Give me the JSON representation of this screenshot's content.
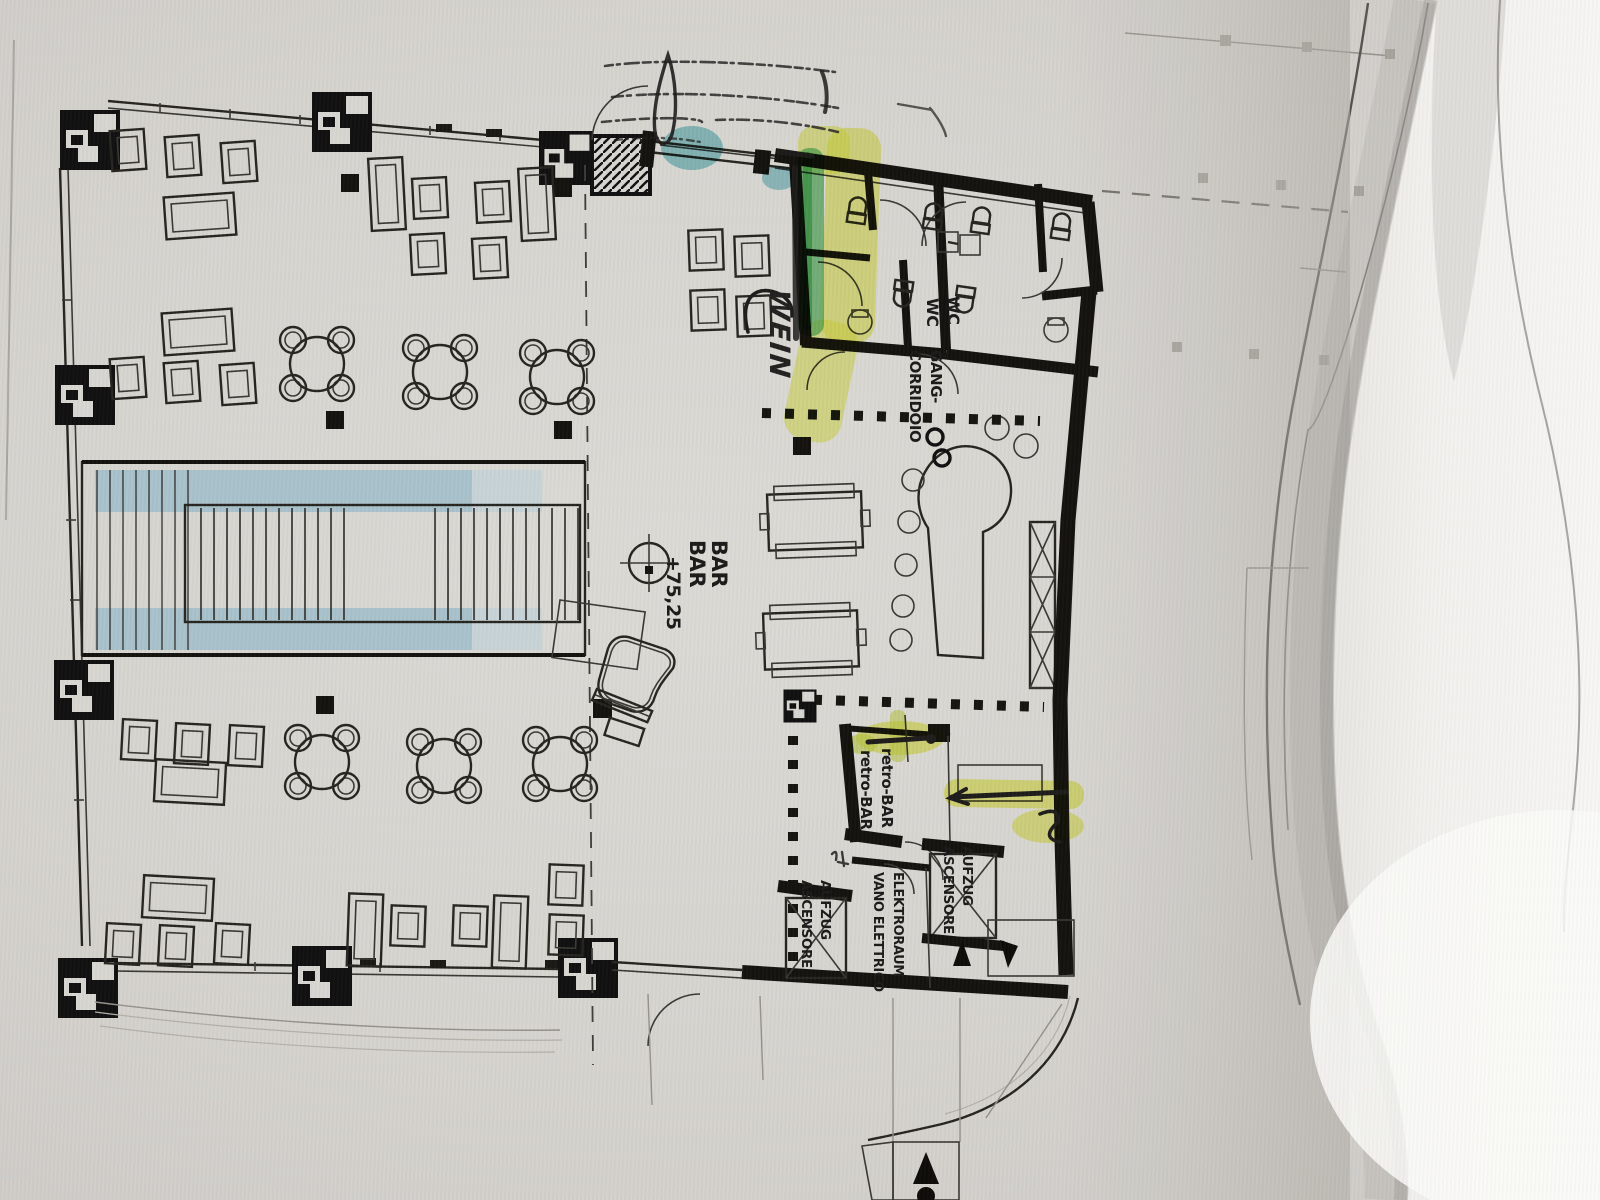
{
  "scene": {
    "kind": "photographed architectural floor plan sheet with highlighter and pen annotations",
    "paper_color": "#d8d5d0",
    "under_sheet_color": "#f2f1ee"
  },
  "plan_labels": {
    "bar": {
      "line1": "BAR",
      "line2": "BAR",
      "level": "+75,25"
    },
    "wc": {
      "line1": "WC",
      "line2": "WC"
    },
    "corridor": {
      "line1": "GANG-",
      "line2": "CORRIDOIO"
    },
    "retro_bar": {
      "line1": "retro-BAR",
      "line2": "retro-BAR"
    },
    "elevator_right": {
      "line1": "AUFZUG",
      "line2": "ASCENSORE"
    },
    "elevator_left": {
      "line1": "AUFZUG",
      "line2": "ASCENSORE"
    },
    "electrical_room": {
      "line1": "ELEKTRORAUM",
      "line2": "VANO ELETTRICO"
    }
  },
  "annotations": {
    "handwritten_word": "WEIN",
    "highlighter_yellow": "#e6ef3f",
    "highlighter_green": "#3fae4d",
    "highlighter_teal": "#46aebb",
    "stair_print_tint": "#a6c0ca"
  }
}
